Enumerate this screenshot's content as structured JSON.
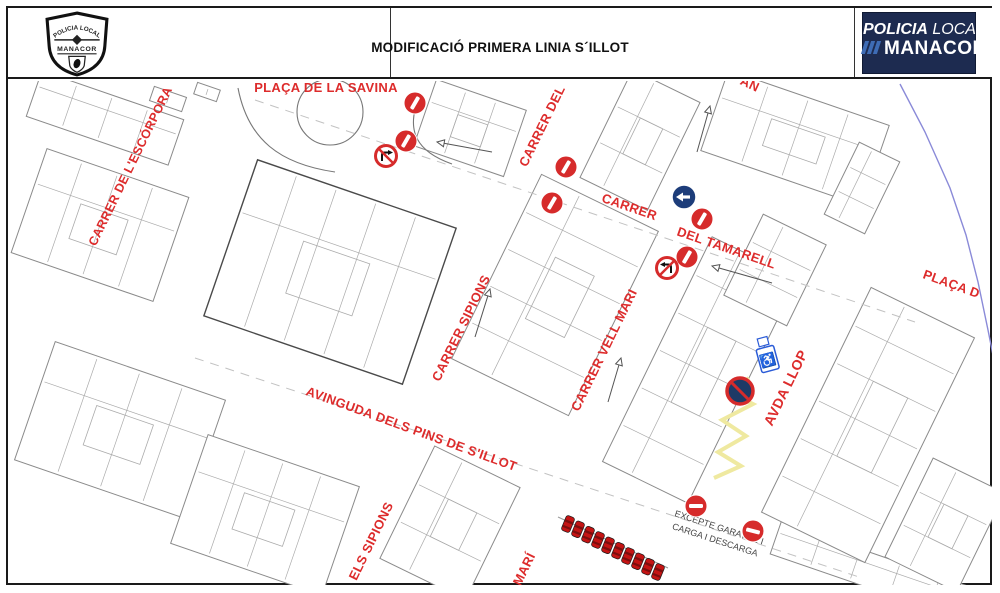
{
  "header": {
    "badge": {
      "top": "POLICIA LOCAL",
      "city": "MANACOR"
    },
    "title": "MODIFICACIÓ PRIMERA LINIA S´ILLOT",
    "logo": {
      "line1_bold": "POLICIA",
      "line1_light": "LOCAL",
      "line2": "MANACOR"
    }
  },
  "colors": {
    "street_label": "#dd2c2c",
    "sign_red": "#d62b2b",
    "one_way_blue": "#1d3d7a",
    "no_stop_fill": "#1e3a66",
    "disabled_blue": "#2a5bd7",
    "coast": "#8a8ad8",
    "zigzag": "#efe9a0",
    "building": "#8a8a8a",
    "building_dark": "#4a4a4a",
    "parcel": "#ababab",
    "car_red": "#c41414",
    "note_text": "#444444"
  },
  "map": {
    "street_labels": [
      {
        "id": "placa-savina",
        "text": "PLAÇA DE LA SAVINA",
        "x": 326,
        "y": 92,
        "rot": 0,
        "size": 13
      },
      {
        "id": "escorpora",
        "text": "CARRER DE L'ESCÓRPORA",
        "x": 134,
        "y": 168,
        "rot": -64,
        "size": 12.5
      },
      {
        "id": "carrer-del",
        "text": "CARRER DEL",
        "x": 546,
        "y": 128,
        "rot": -64,
        "size": 13
      },
      {
        "id": "tamarell-a",
        "text": "CARRER",
        "x": 628,
        "y": 211,
        "rot": 19,
        "size": 13
      },
      {
        "id": "tamarell-b",
        "text": "DEL TAMARELL",
        "x": 725,
        "y": 252,
        "rot": 19,
        "size": 13
      },
      {
        "id": "sipions",
        "text": "CARRER SIPIONS",
        "x": 465,
        "y": 330,
        "rot": -64,
        "size": 13
      },
      {
        "id": "vell-mari",
        "text": "CARRER VELL MARI",
        "x": 608,
        "y": 352,
        "rot": -64,
        "size": 13
      },
      {
        "id": "avda-llop",
        "text": "AVDA LLOP",
        "x": 790,
        "y": 390,
        "rot": -64,
        "size": 14
      },
      {
        "id": "placa-d",
        "text": "PLAÇA D",
        "x": 950,
        "y": 288,
        "rot": 20,
        "size": 13
      },
      {
        "id": "avinguda",
        "text": "AVINGUDA DELS PINS DE S'ILLOT",
        "x": 410,
        "y": 433,
        "rot": 20,
        "size": 13
      },
      {
        "id": "els-sipions",
        "text": "ELS SIPIONS",
        "x": 375,
        "y": 543,
        "rot": -64,
        "size": 13
      },
      {
        "id": "mari",
        "text": "MARÍ",
        "x": 528,
        "y": 571,
        "rot": -64,
        "size": 13
      },
      {
        "id": "cut-an",
        "text": "AN",
        "x": 748,
        "y": 88,
        "rot": 25,
        "size": 13
      }
    ],
    "note": {
      "lines": [
        "EXCEPTE GARATGE I",
        "CARGA I DESCARGA"
      ],
      "x": 716,
      "y": 537,
      "rot": 18,
      "size": 9
    },
    "signs": {
      "no_entry": [
        {
          "x": 415,
          "y": 103,
          "rot": -60
        },
        {
          "x": 406,
          "y": 141,
          "rot": -60
        },
        {
          "x": 566,
          "y": 167,
          "rot": -60
        },
        {
          "x": 552,
          "y": 203,
          "rot": -60
        },
        {
          "x": 702,
          "y": 219,
          "rot": -60
        },
        {
          "x": 687,
          "y": 257,
          "rot": -60
        },
        {
          "x": 696,
          "y": 506,
          "rot": 0
        },
        {
          "x": 753,
          "y": 531,
          "rot": 14
        }
      ],
      "no_turn": [
        {
          "x": 386,
          "y": 156,
          "dir": "right"
        },
        {
          "x": 667,
          "y": 268,
          "dir": "left"
        }
      ],
      "one_way": [
        {
          "x": 684,
          "y": 197,
          "dir": "left"
        }
      ],
      "no_stopping": [
        {
          "x": 740,
          "y": 391
        }
      ],
      "disabled_parking": [
        {
          "x": 768,
          "y": 360,
          "rot": -15,
          "glyph": "♿"
        }
      ]
    },
    "arrows": [
      {
        "hx": 437,
        "hy": 142,
        "tx": 492,
        "ty": 152
      },
      {
        "hx": 712,
        "hy": 266,
        "tx": 772,
        "ty": 283
      },
      {
        "hx": 490,
        "hy": 289,
        "tx": 475,
        "ty": 337
      },
      {
        "hx": 621,
        "hy": 358,
        "tx": 608,
        "ty": 402
      },
      {
        "hx": 710,
        "hy": 106,
        "tx": 697,
        "ty": 152
      }
    ],
    "zigzag": [
      [
        749,
        378
      ],
      [
        729,
        392
      ],
      [
        753,
        404
      ],
      [
        722,
        420
      ],
      [
        746,
        436
      ],
      [
        718,
        452
      ],
      [
        741,
        466
      ],
      [
        714,
        478
      ]
    ],
    "coast": [
      [
        900,
        84
      ],
      [
        925,
        132
      ],
      [
        950,
        188
      ],
      [
        966,
        235
      ],
      [
        978,
        282
      ],
      [
        988,
        330
      ],
      [
        993,
        355
      ]
    ],
    "cars": {
      "count": 10,
      "x1": 568,
      "y1": 524,
      "x2": 658,
      "y2": 572
    }
  }
}
